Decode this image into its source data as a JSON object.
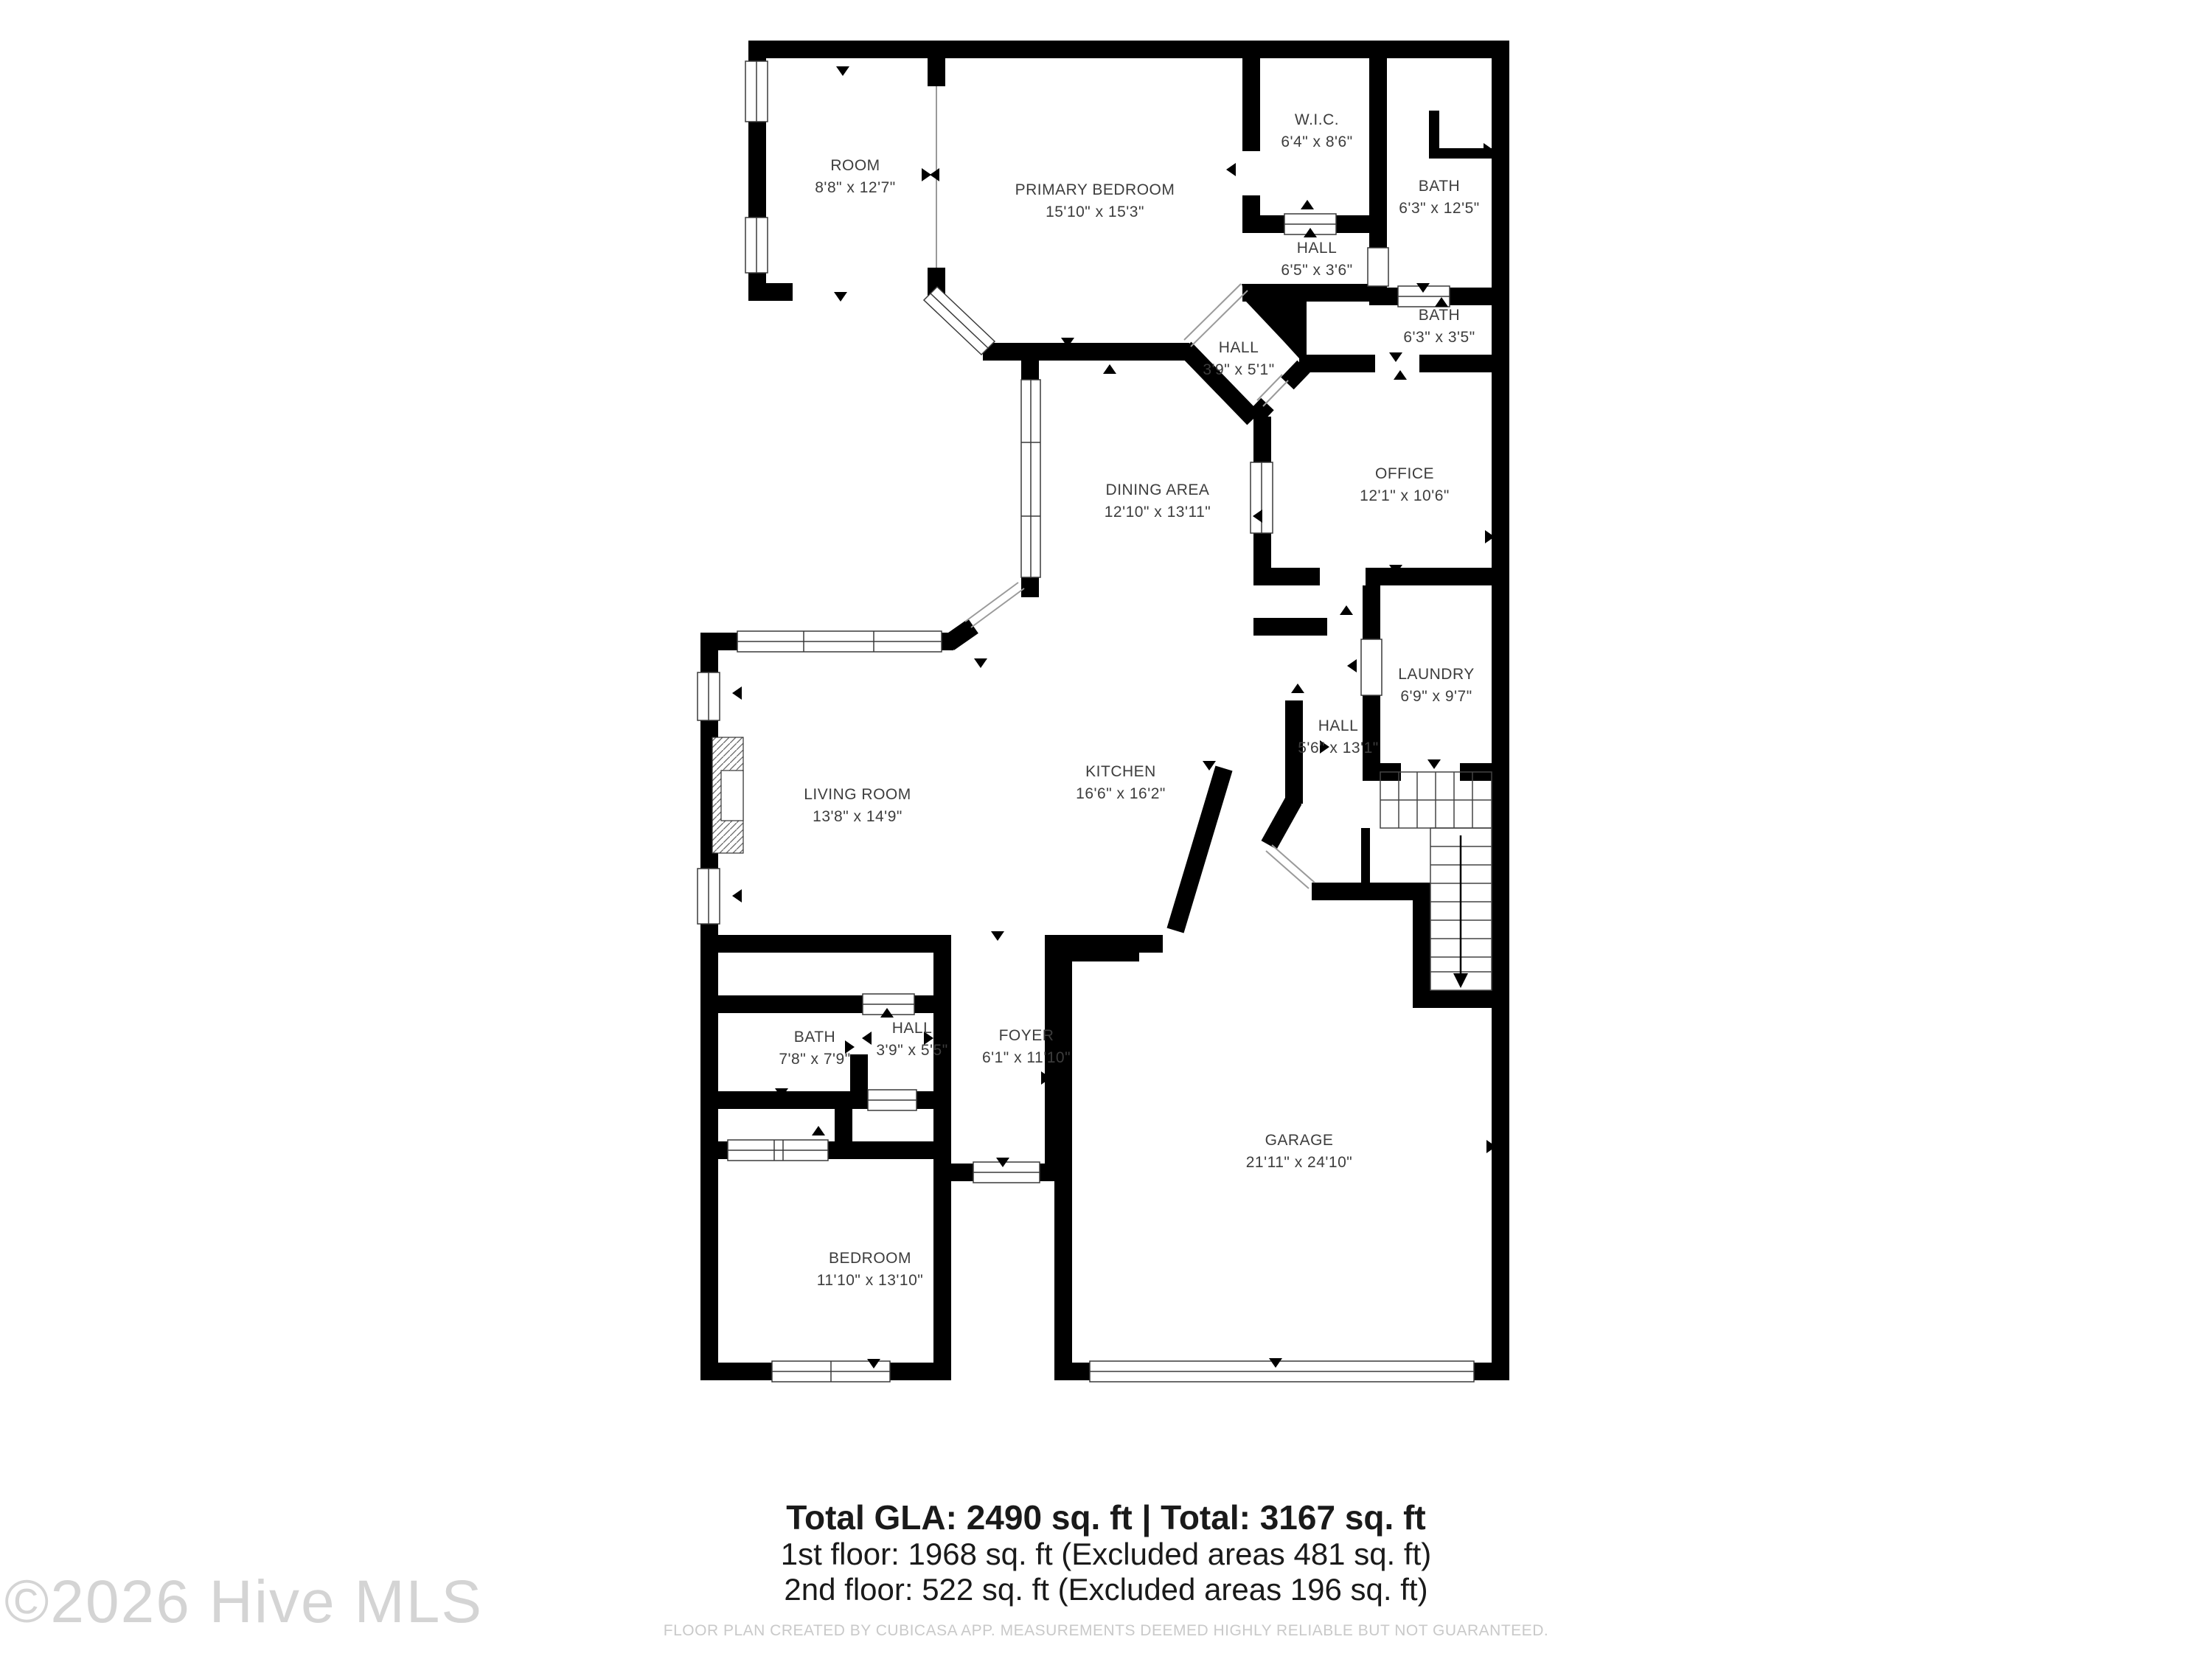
{
  "floorplan": {
    "rooms": {
      "room": {
        "name": "ROOM",
        "dims": "8'8\" x 12'7\""
      },
      "primary_bedroom": {
        "name": "PRIMARY BEDROOM",
        "dims": "15'10\" x 15'3\""
      },
      "wic": {
        "name": "W.I.C.",
        "dims": "6'4\" x 8'6\""
      },
      "bath1": {
        "name": "BATH",
        "dims": "6'3\" x 12'5\""
      },
      "hall1": {
        "name": "HALL",
        "dims": "6'5\" x 3'6\""
      },
      "bath2": {
        "name": "BATH",
        "dims": "6'3\" x 3'5\""
      },
      "hall2": {
        "name": "HALL",
        "dims": "3'9\" x 5'1\""
      },
      "office": {
        "name": "OFFICE",
        "dims": "12'1\" x 10'6\""
      },
      "dining": {
        "name": "DINING AREA",
        "dims": "12'10\" x 13'11\""
      },
      "living": {
        "name": "LIVING ROOM",
        "dims": "13'8\" x 14'9\""
      },
      "kitchen": {
        "name": "KITCHEN",
        "dims": "16'6\" x 16'2\""
      },
      "laundry": {
        "name": "LAUNDRY",
        "dims": "6'9\" x 9'7\""
      },
      "hall3": {
        "name": "HALL",
        "dims": "5'6\" x 13'1\""
      },
      "bath3": {
        "name": "BATH",
        "dims": "7'8\" x 7'9\""
      },
      "hall4": {
        "name": "HALL",
        "dims": "3'9\" x 5'5\""
      },
      "foyer": {
        "name": "FOYER",
        "dims": "6'1\" x 11'10\""
      },
      "garage": {
        "name": "GARAGE",
        "dims": "21'11\" x 24'10\""
      },
      "bedroom": {
        "name": "BEDROOM",
        "dims": "11'10\" x 13'10\""
      }
    },
    "colors": {
      "wall": "#000000",
      "label": "#3d3d3d",
      "disclaimer": "#c9c9c9",
      "watermark": "#d4d4d4"
    }
  },
  "footer": {
    "line1": "Total GLA: 2490 sq. ft | Total: 3167 sq. ft",
    "line2": "1st floor: 1968 sq. ft (Excluded areas 481 sq. ft)",
    "line3": "2nd floor: 522 sq. ft (Excluded areas 196 sq. ft)"
  },
  "disclaimer": "FLOOR PLAN CREATED BY CUBICASA APP. MEASUREMENTS DEEMED HIGHLY RELIABLE BUT NOT GUARANTEED.",
  "watermark": "©2026 Hive MLS"
}
